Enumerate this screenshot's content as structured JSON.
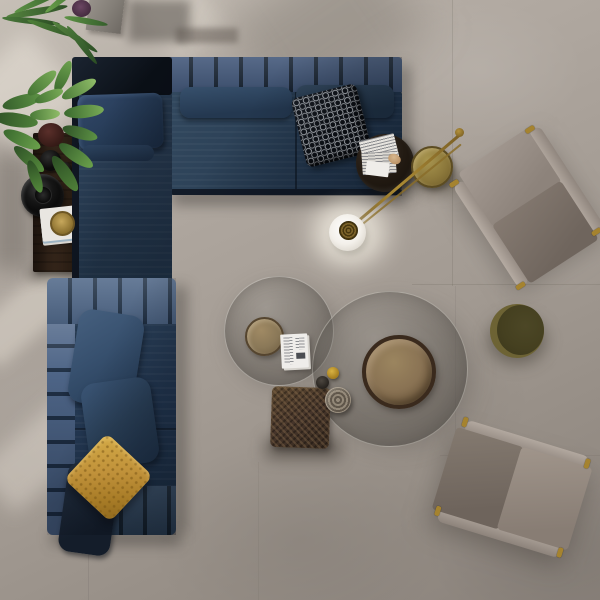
{
  "scene": {
    "description": "Top-down render of a living room: navy L-shaped modular sectional sofa, dark wood console with plants and black vessels, brass globe floor lamp, two smoked-glass round coffee tables with bronze tray tables, woven leather pouf, olive round pouf, and two taupe lounge chairs on a warm grey concrete tile floor.",
    "view": "bird's eye / top-down",
    "no_visible_text": true
  },
  "palette": {
    "floor_light": "#c6bfb6",
    "floor_mid": "#a8a098",
    "floor_dark": "#8a827b",
    "sofa_navy": "#2b4057",
    "sofa_navy_dark": "#1c2c3f",
    "sofa_channel_light": "#4e6687",
    "sofa_back_pad": "#10161f",
    "pillow_pattern_black": "#0d1014",
    "pillow_pattern_white": "#dfe4ea",
    "pillow_ochre": "#c0913a",
    "wood_console": "#2c1f15",
    "brass": "#9a7b33",
    "lamp_globe": "#f4f1ea",
    "glass_smoke": "rgba(80,76,70,0.40)",
    "bronze_tray": "#8a7354",
    "mini_table_bronze": "#8d7b5c",
    "pouf_woven_brown": "#4a3829",
    "pouf_olive": "#55502a",
    "chair_taupe_light": "#a89e96",
    "chair_taupe_dark": "#7d7269",
    "plant_green": "#5c8a44"
  },
  "objects": [
    {
      "id": "sectional-sofa",
      "label": "navy modular sectional sofa (L-shaped)"
    },
    {
      "id": "chaise-section",
      "label": "upper-left chaise with dark back pad and navy pillow"
    },
    {
      "id": "lower-sofa-section",
      "label": "lower sofa section with channel-tufted arm"
    },
    {
      "id": "patterned-pillow",
      "label": "black & white geometric lattice pillow"
    },
    {
      "id": "ochre-pillow",
      "label": "ochre quilted pillow"
    },
    {
      "id": "console-table",
      "label": "dark wood console shelf"
    },
    {
      "id": "black-bowl",
      "label": "glossy black bowl"
    },
    {
      "id": "black-vases",
      "label": "black vessels"
    },
    {
      "id": "console-magazines",
      "label": "magazine stack with gold dish"
    },
    {
      "id": "leafy-plant",
      "label": "green leafy plant"
    },
    {
      "id": "palm-plant",
      "label": "palm fronds"
    },
    {
      "id": "concrete-planter",
      "label": "concrete planter box"
    },
    {
      "id": "round-side-table",
      "label": "dark round side table with magazines"
    },
    {
      "id": "gold-side-table",
      "label": "brass disc side table"
    },
    {
      "id": "floor-lamp",
      "label": "brass stem floor lamp with white globe"
    },
    {
      "id": "glass-coffee-table-small",
      "label": "smoked glass round coffee table (small)"
    },
    {
      "id": "glass-coffee-table-large",
      "label": "smoked glass round coffee table (large)"
    },
    {
      "id": "bronze-tray-table",
      "label": "bronze round tray table"
    },
    {
      "id": "mini-bronze-table",
      "label": "small bronze side table"
    },
    {
      "id": "coffee-table-magazines",
      "label": "magazines on glass table"
    },
    {
      "id": "gold-votive",
      "label": "small gold cup"
    },
    {
      "id": "dark-votive",
      "label": "small dark cup"
    },
    {
      "id": "metal-vessel",
      "label": "turned metal vessel"
    },
    {
      "id": "woven-pouf",
      "label": "brown woven leather pouf"
    },
    {
      "id": "olive-pouf",
      "label": "olive green round pouf"
    },
    {
      "id": "armchair-top-right",
      "label": "taupe lounge chair with brass frame"
    },
    {
      "id": "armchair-bottom-right",
      "label": "taupe lounge chair with brass frame"
    }
  ]
}
